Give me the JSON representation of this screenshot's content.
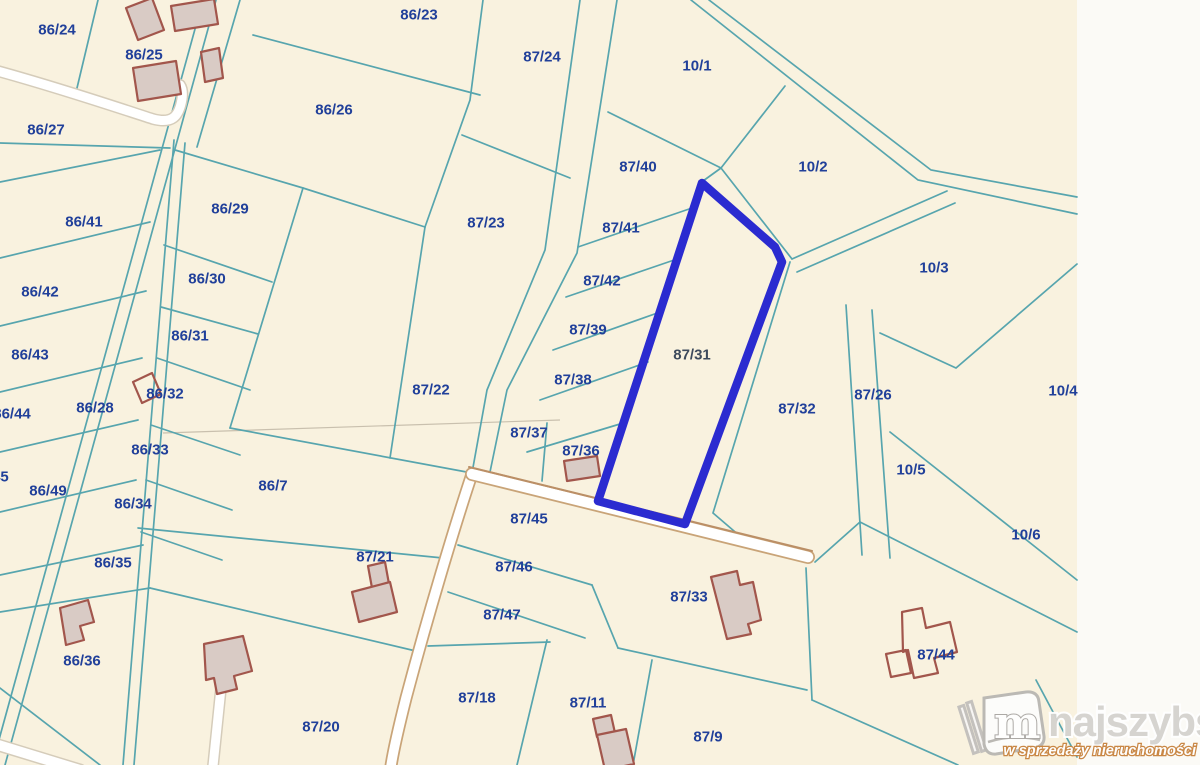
{
  "map": {
    "type": "cadastral-parcel-map",
    "highlighted_parcel": "87/31",
    "colors": {
      "map_background": "#f9f2df",
      "outside_background": "#fbfaf6",
      "parcel_boundary": "#57a5ae",
      "parcel_label": "#21409a",
      "highlight_outline": "#2b2bd0",
      "building_fill": "#d9cbc5",
      "building_outline": "#a2564c",
      "road_fill": "#ffffff",
      "road_edge": "#bb8f66"
    },
    "parcels": [
      {
        "id": "86/24",
        "x": 57,
        "y": 30
      },
      {
        "id": "86/25",
        "x": 144,
        "y": 55
      },
      {
        "id": "86/23",
        "x": 419,
        "y": 15
      },
      {
        "id": "87/24",
        "x": 542,
        "y": 57
      },
      {
        "id": "10/1",
        "x": 697,
        "y": 66
      },
      {
        "id": "86/26",
        "x": 334,
        "y": 110
      },
      {
        "id": "86/27",
        "x": 46,
        "y": 130
      },
      {
        "id": "87/40",
        "x": 638,
        "y": 167
      },
      {
        "id": "10/2",
        "x": 813,
        "y": 167
      },
      {
        "id": "86/29",
        "x": 230,
        "y": 209
      },
      {
        "id": "86/41",
        "x": 84,
        "y": 222
      },
      {
        "id": "87/23",
        "x": 486,
        "y": 223
      },
      {
        "id": "87/41",
        "x": 621,
        "y": 228
      },
      {
        "id": "10/3",
        "x": 934,
        "y": 268
      },
      {
        "id": "86/30",
        "x": 207,
        "y": 279
      },
      {
        "id": "87/42",
        "x": 602,
        "y": 281
      },
      {
        "id": "86/42",
        "x": 40,
        "y": 292
      },
      {
        "id": "87/39",
        "x": 588,
        "y": 330
      },
      {
        "id": "86/31",
        "x": 190,
        "y": 336
      },
      {
        "id": "86/43",
        "x": 30,
        "y": 355
      },
      {
        "id": "87/31",
        "x": 692,
        "y": 355,
        "dim": true
      },
      {
        "id": "87/38",
        "x": 573,
        "y": 380
      },
      {
        "id": "87/22",
        "x": 431,
        "y": 390
      },
      {
        "id": "10/4",
        "x": 1063,
        "y": 391
      },
      {
        "id": "86/32",
        "x": 165,
        "y": 394
      },
      {
        "id": "87/26",
        "x": 873,
        "y": 395
      },
      {
        "id": "86/28",
        "x": 95,
        "y": 408
      },
      {
        "id": "87/32",
        "x": 797,
        "y": 409
      },
      {
        "id": "86/44",
        "x": 12,
        "y": 414
      },
      {
        "id": "87/37",
        "x": 529,
        "y": 433
      },
      {
        "id": "86/33",
        "x": 150,
        "y": 450
      },
      {
        "id": "87/36",
        "x": 581,
        "y": 451
      },
      {
        "id": "10/5",
        "x": 911,
        "y": 470
      },
      {
        "id": "86/45",
        "x": -10,
        "y": 477
      },
      {
        "id": "86/7",
        "x": 273,
        "y": 486
      },
      {
        "id": "86/49",
        "x": 48,
        "y": 491
      },
      {
        "id": "86/34",
        "x": 133,
        "y": 504
      },
      {
        "id": "87/45",
        "x": 529,
        "y": 519
      },
      {
        "id": "10/6",
        "x": 1026,
        "y": 535
      },
      {
        "id": "87/21",
        "x": 375,
        "y": 557
      },
      {
        "id": "86/35",
        "x": 113,
        "y": 563
      },
      {
        "id": "87/46",
        "x": 514,
        "y": 567
      },
      {
        "id": "87/33",
        "x": 689,
        "y": 597
      },
      {
        "id": "87/47",
        "x": 502,
        "y": 615
      },
      {
        "id": "87/44",
        "x": 936,
        "y": 655
      },
      {
        "id": "86/36",
        "x": 82,
        "y": 661
      },
      {
        "id": "87/18",
        "x": 477,
        "y": 698
      },
      {
        "id": "87/11",
        "x": 588,
        "y": 703
      },
      {
        "id": "87/20",
        "x": 321,
        "y": 727
      },
      {
        "id": "87/9",
        "x": 708,
        "y": 737
      }
    ]
  },
  "logo": {
    "brand": "najszybsi",
    "tagline": "w sprzedaży nieruchomości",
    "icon": "book-m-icon",
    "icon_letter": "m"
  }
}
